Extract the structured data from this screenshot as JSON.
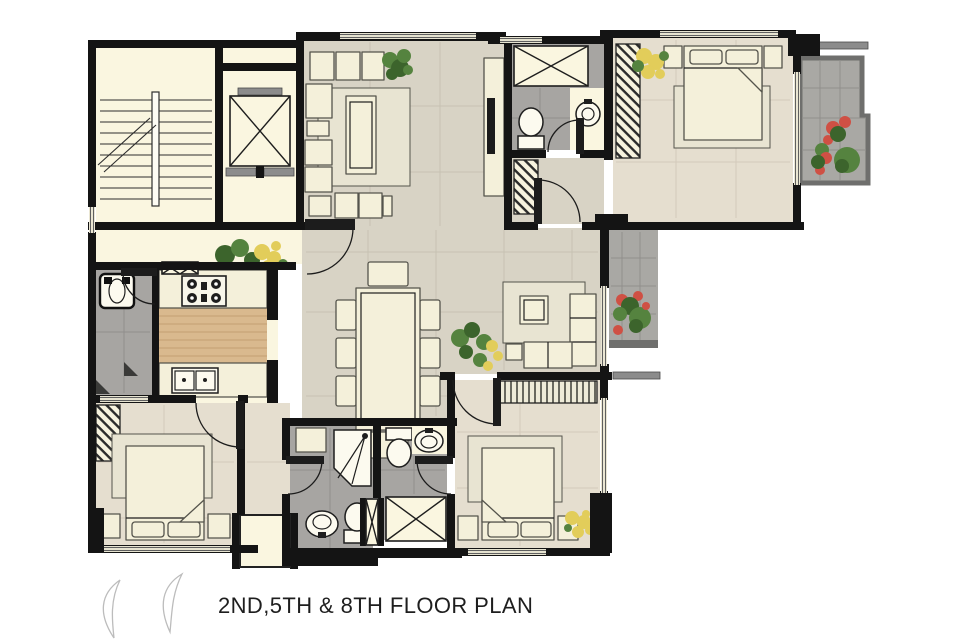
{
  "title": "2ND,5TH & 8TH FLOOR PLAN",
  "colors": {
    "background": "#ffffff",
    "wall": "#141414",
    "cream": "#faf6e0",
    "tile": "#d8d3c5",
    "tile_grout": "#c7c2b2",
    "bedroom_floor": "#e5decf",
    "bedroom_grout": "#d3cabb",
    "bath_floor": "#a7a5a2",
    "bath_grout": "#918f8c",
    "balcony_floor": "#a9a8a4",
    "balcony_wall": "#6f6f6d",
    "wood": "#d9b98e",
    "wood_line": "#c29f72",
    "furniture": "#f4f0da",
    "furniture_outline": "#55544c",
    "fixture": "#fcfaef",
    "rug": "#e8e4d2",
    "door": "#1c1c1c",
    "window_line": "#5f5f5f",
    "ledge": "#8c8c8c",
    "plant_green": "#55833f",
    "plant_dark": "#3c642c",
    "flower_red": "#cf5044",
    "flower_yellow": "#e2cd5a",
    "leaf_outline": "#bcbcbc",
    "text": "#1e1e1e"
  }
}
